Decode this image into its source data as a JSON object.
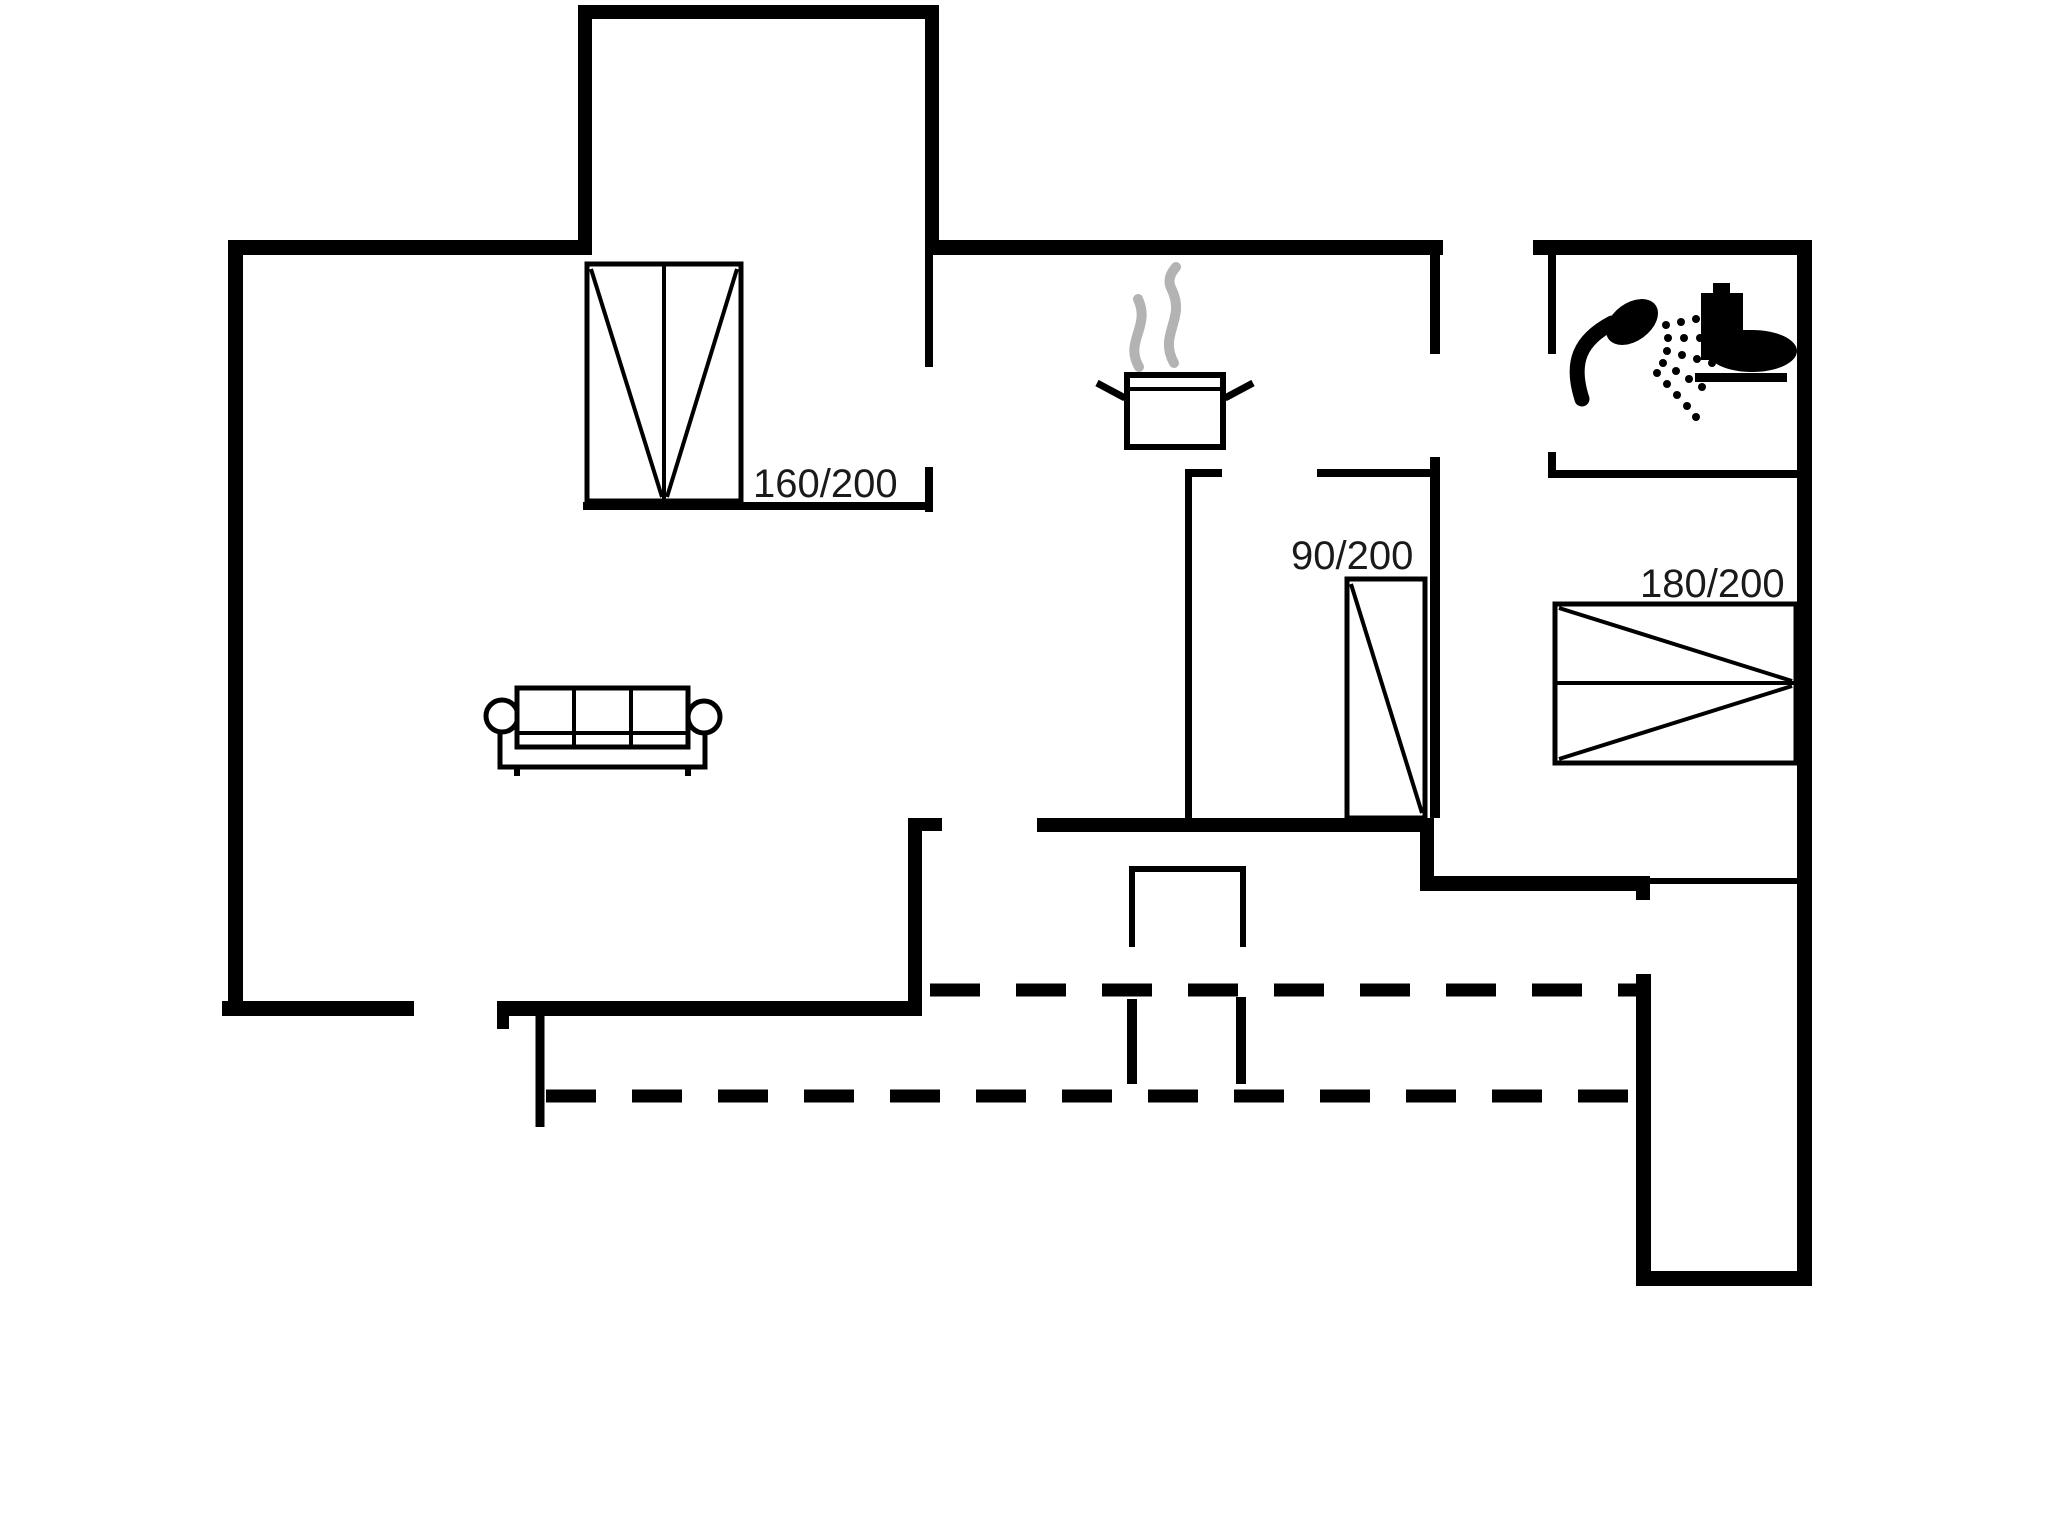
{
  "title": "Holiday house floor plan",
  "colors": {
    "background": "#ffffff",
    "wall": "#000000",
    "furniture_line": "#000000",
    "steam": "#b3b3b3",
    "label_text": "#1a1a1a"
  },
  "beds": {
    "alcove_bed": {
      "label": "160/200",
      "type": "double-bed"
    },
    "middle_bed": {
      "label": "90/200",
      "type": "single-bed"
    },
    "right_bed": {
      "label": "180/200",
      "type": "double-bed"
    }
  },
  "icons": {
    "stove": "pot-with-steam-icon",
    "shower": "shower-head-icon",
    "toilet": "toilet-icon",
    "sofa": "sofa-icon"
  },
  "terrace": {
    "outline_style": "dashed"
  }
}
